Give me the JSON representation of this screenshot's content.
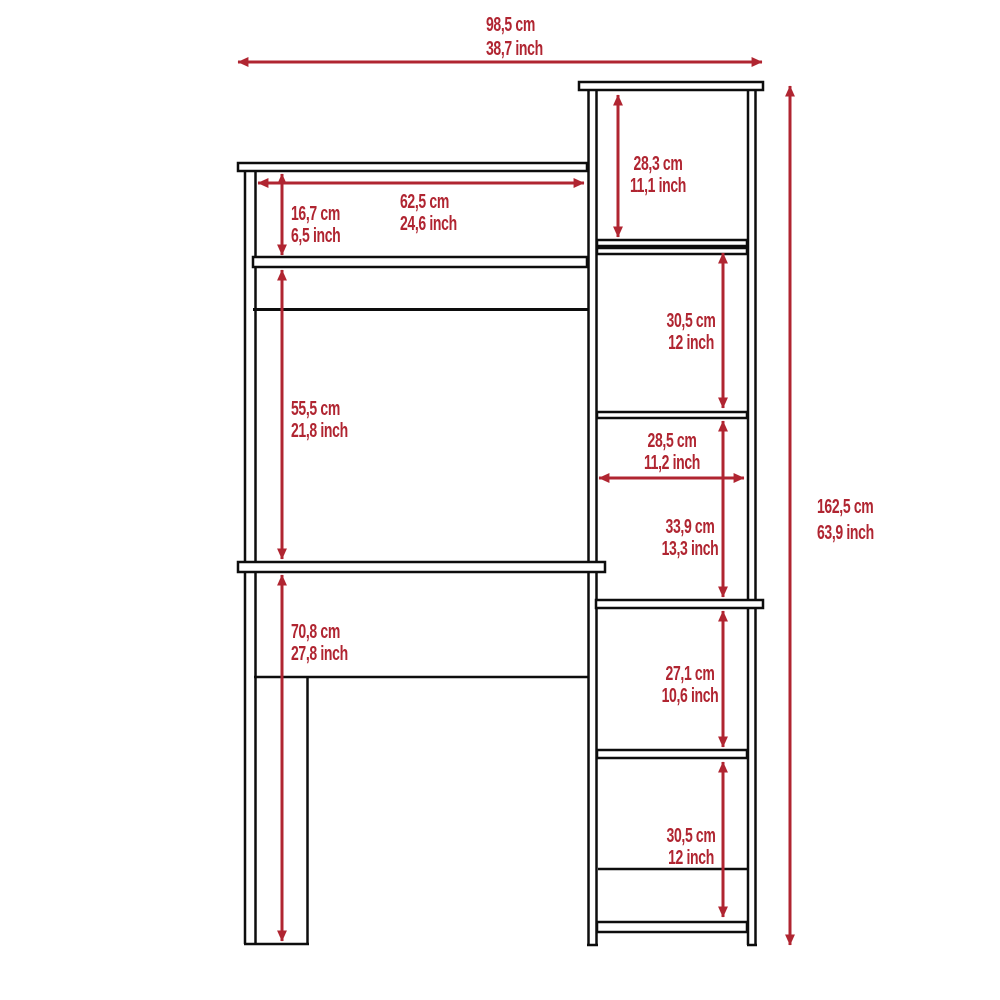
{
  "diagram": {
    "kind": "furniture-dimension-drawing",
    "subject": "desk with hutch and side bookcase shelving unit",
    "colors": {
      "dimension": "#b02531",
      "structure": "#0d0d0d",
      "background": "#ffffff"
    },
    "dimensions": {
      "total_width": {
        "cm": "98,5 cm",
        "inch": "38,7 inch"
      },
      "total_height": {
        "cm": "162,5 cm",
        "inch": "63,9 inch"
      },
      "hutch_opening_width": {
        "cm": "62,5 cm",
        "inch": "24,6 inch"
      },
      "hutch_opening_height": {
        "cm": "16,7 cm",
        "inch": "6,5 inch"
      },
      "desk_clearance_height": {
        "cm": "55,5 cm",
        "inch": "21,8 inch"
      },
      "desk_surface_height": {
        "cm": "70,8 cm",
        "inch": "27,8 inch"
      },
      "top_cubby_height": {
        "cm": "28,3 cm",
        "inch": "11,1 inch"
      },
      "second_cubby_height": {
        "cm": "30,5 cm",
        "inch": "12 inch"
      },
      "cubby_width": {
        "cm": "28,5 cm",
        "inch": "11,2 inch"
      },
      "third_cubby_height": {
        "cm": "33,9 cm",
        "inch": "13,3 inch"
      },
      "fourth_cubby_height": {
        "cm": "27,1 cm",
        "inch": "10,6 inch"
      },
      "bottom_cubby_height": {
        "cm": "30,5 cm",
        "inch": "12 inch"
      }
    }
  }
}
